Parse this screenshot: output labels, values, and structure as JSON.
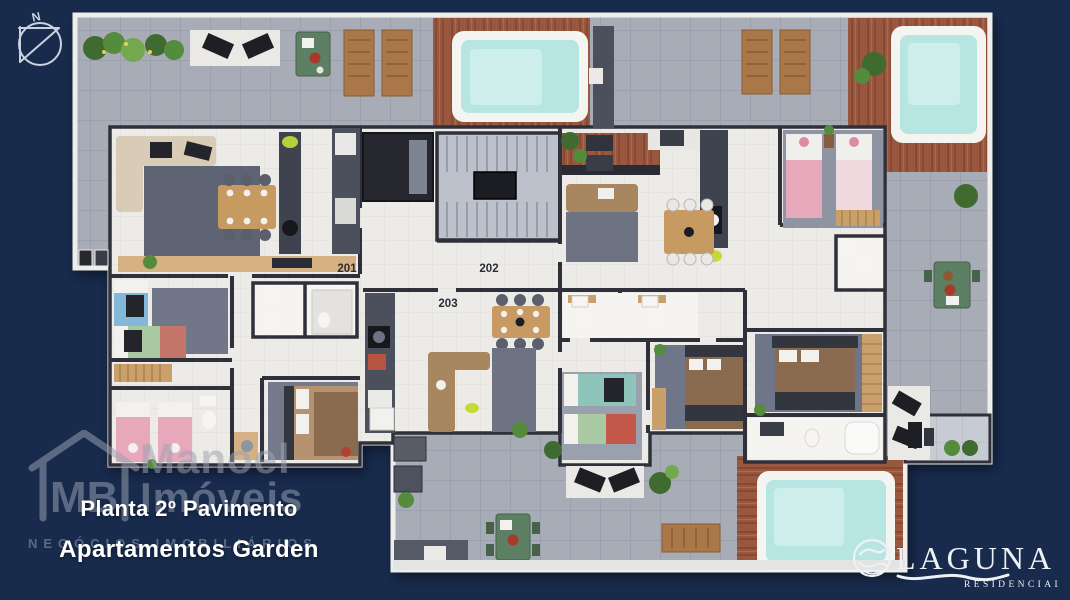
{
  "title": {
    "line1": "Planta 2º Pavimento",
    "line2": "Apartamentos Garden"
  },
  "compass": {
    "label": "N"
  },
  "units": [
    {
      "label": "201"
    },
    {
      "label": "202"
    },
    {
      "label": "203"
    }
  ],
  "watermark": {
    "initials": "MB",
    "name_top": "Manoel",
    "name_bottom": "Imóveis",
    "tagline": "NEGÓCIOS IMOBILIÁRIOS"
  },
  "brand": {
    "name": "LAGUNA",
    "subtitle": "RESIDENCIAL"
  },
  "scene": {
    "type": "architectural floor plan render, top view",
    "pools_visible": 3,
    "palette": {
      "background": "#182b4d",
      "terrace_tile": "#a7acb7",
      "deck_wood": "#99573f",
      "pool_water": "#b7e5e1",
      "interior_floor": "#edebe7",
      "wall": "#2f3039",
      "caption_text": "#ffffff",
      "watermark_grey": "#9aa3b3",
      "brand_white": "#eef1f4"
    }
  }
}
